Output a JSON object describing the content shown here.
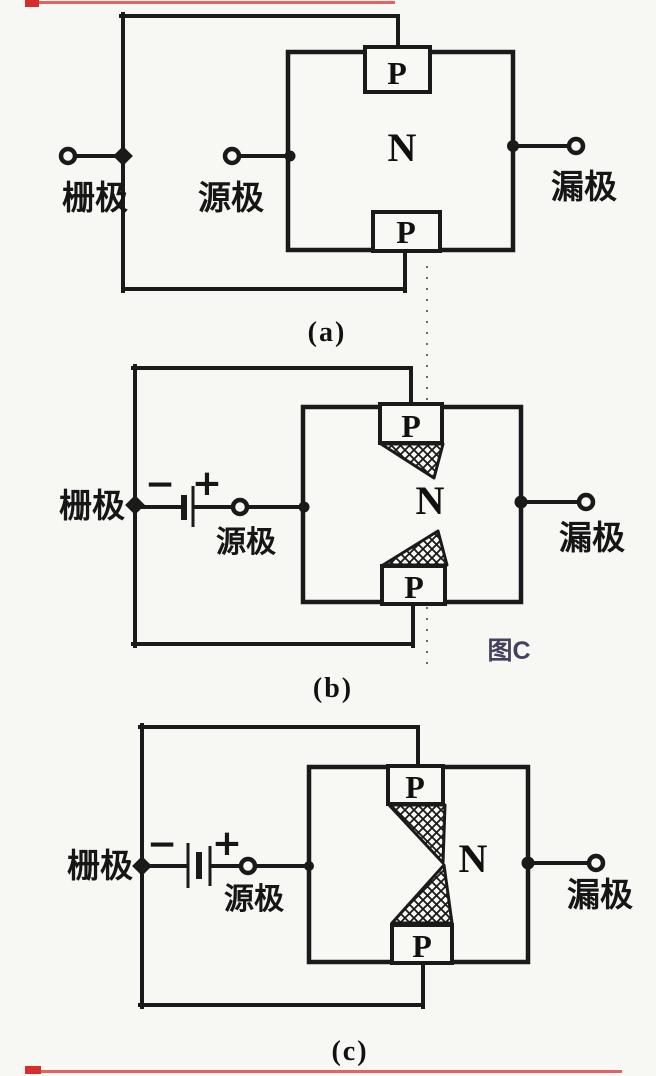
{
  "page": {
    "background": "#f7f7f4",
    "ink": "#1a1a1a",
    "note_color": "#45405e",
    "scan_mark_color": "#e04844"
  },
  "figure": {
    "a": {
      "caption": "(a)",
      "gate_label": "栅极",
      "source_label": "源极",
      "drain_label": "漏极",
      "channel_label": "N",
      "p_top_label": "P",
      "p_bottom_label": "P"
    },
    "b": {
      "caption": "(b)",
      "gate_label": "栅极",
      "source_label": "源极",
      "drain_label": "漏极",
      "channel_label": "N",
      "p_top_label": "P",
      "p_bottom_label": "P",
      "battery_minus": "−",
      "battery_plus": "+",
      "figure_note": "图C"
    },
    "c": {
      "caption": "(c)",
      "gate_label": "栅极",
      "source_label": "源极",
      "drain_label": "漏极",
      "channel_label": "N",
      "p_top_label": "P",
      "p_bottom_label": "P",
      "battery_minus": "−",
      "battery_plus": "+"
    }
  }
}
